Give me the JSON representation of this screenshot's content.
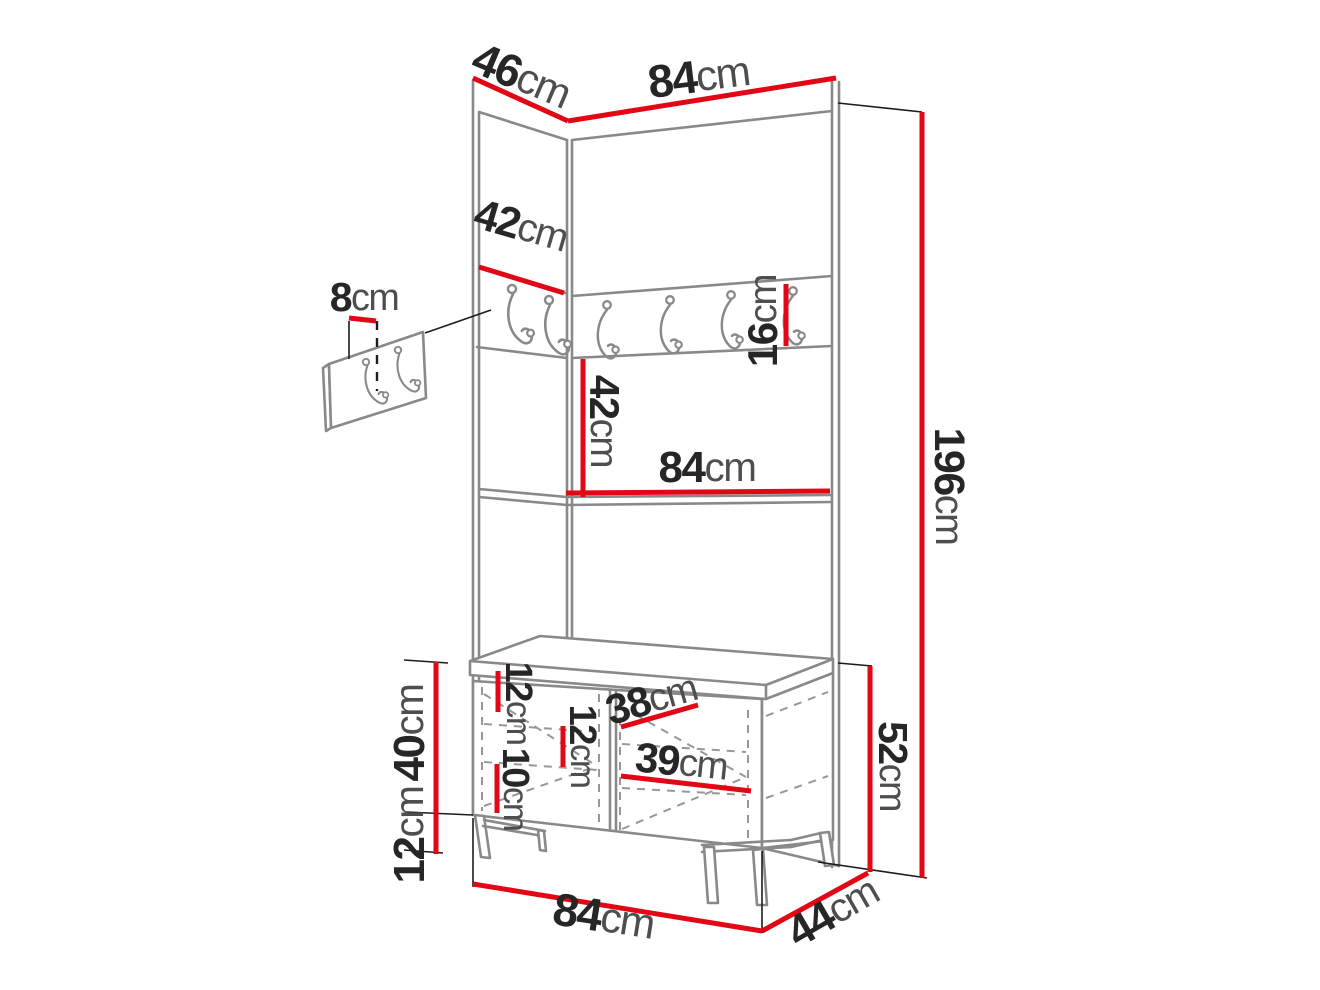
{
  "page": {
    "background": "#ffffff"
  },
  "colors": {
    "dimension_red": "#e30615",
    "number_text": "#262626",
    "unit_text": "#4e4e4e",
    "furniture_line": "#898989",
    "thin_line": "#1c1c1c"
  },
  "diagram": {
    "type": "furniture-dimension-drawing",
    "subject": "hallway wardrobe with hook rail, shelf and shoe-cabinet bench, plus detail of 2-hook wall plate",
    "unit": "cm",
    "hook_count_rail": 6,
    "hook_count_detail_plate": 2,
    "dims": {
      "top_side_depth": {
        "value": "46",
        "unit": "cm"
      },
      "top_width": {
        "value": "84",
        "unit": "cm"
      },
      "side_hook_panel_width": {
        "value": "42",
        "unit": "cm"
      },
      "hook_plate_height": {
        "value": "8",
        "unit": "cm"
      },
      "hook_height": {
        "value": "16",
        "unit": "cm"
      },
      "hook_rail_to_shelf": {
        "value": "42",
        "unit": "cm"
      },
      "shelf_width": {
        "value": "84",
        "unit": "cm"
      },
      "total_height": {
        "value": "196",
        "unit": "cm"
      },
      "bench_body_height": {
        "value": "40",
        "unit": "cm"
      },
      "bench_leg_height": {
        "value": "12",
        "unit": "cm"
      },
      "bench_total_height": {
        "value": "52",
        "unit": "cm"
      },
      "bench_top_clearance": {
        "value": "12",
        "unit": "cm"
      },
      "bench_bottom_clearance": {
        "value": "10",
        "unit": "cm"
      },
      "bench_middle_clearance": {
        "value": "12",
        "unit": "cm"
      },
      "bench_upper_shelf_depth": {
        "value": "38",
        "unit": "cm"
      },
      "bench_lower_shelf_depth": {
        "value": "39",
        "unit": "cm"
      },
      "bench_width": {
        "value": "84",
        "unit": "cm"
      },
      "bench_depth": {
        "value": "44",
        "unit": "cm"
      }
    }
  }
}
